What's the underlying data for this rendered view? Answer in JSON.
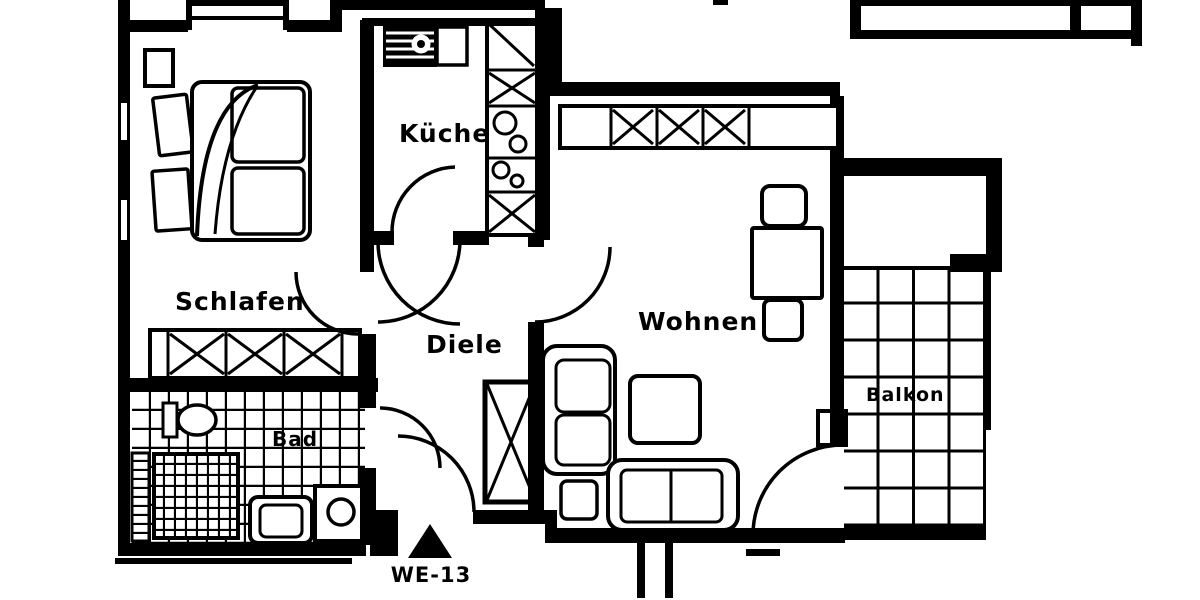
{
  "plan": {
    "rooms": [
      {
        "name": "schlafen",
        "label": "Schlafen"
      },
      {
        "name": "kueche",
        "label": "Küche"
      },
      {
        "name": "diele",
        "label": "Diele"
      },
      {
        "name": "wohnen",
        "label": "Wohnen"
      },
      {
        "name": "bad",
        "label": "Bad"
      },
      {
        "name": "balkon",
        "label": "Balkon"
      }
    ],
    "unit_marker": {
      "label": "WE-13"
    },
    "colors": {
      "ink": "#000000",
      "paper": "#ffffff"
    }
  }
}
